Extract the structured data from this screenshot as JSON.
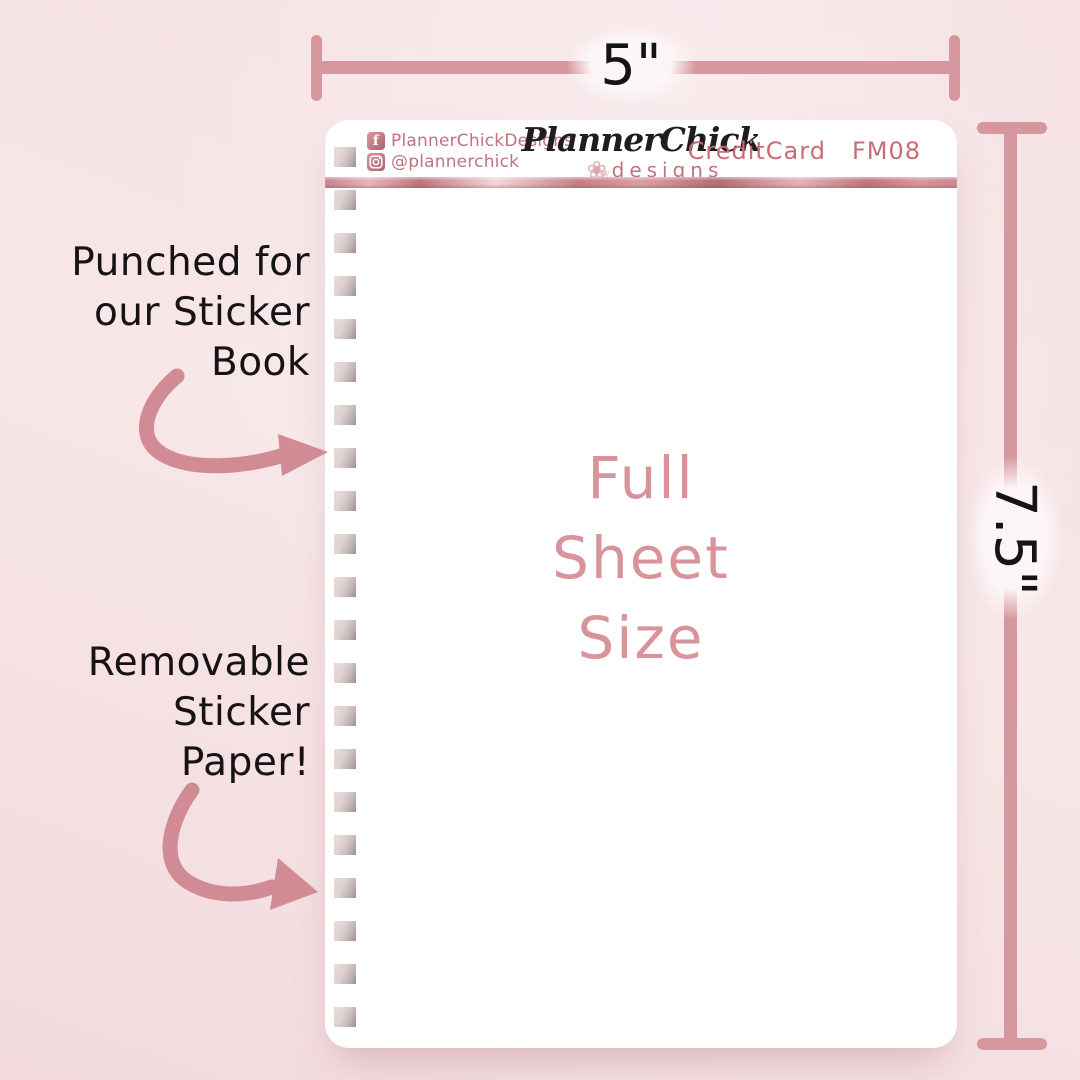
{
  "colors": {
    "background": "#f6e2e4",
    "sheet": "#ffffff",
    "dimension_line": "#d6979f",
    "arrow": "#d18b95",
    "social_text": "#c0737e",
    "product_text": "#c66d77",
    "logo_sub_text": "#c4737c",
    "center_text": "#d9949b",
    "annotation_text": "#161314",
    "rose_bar_light": "#f2d7d9",
    "rose_bar_dark": "#b46c76"
  },
  "sheet": {
    "punch_hole_count": 21,
    "header": {
      "facebook_label": "PlannerChickDesigns",
      "instagram_label": "@plannerchick",
      "logo_script": "PlannerChick",
      "logo_sub": "designs",
      "flower_glyph": "❀",
      "product_name": "CreditCard",
      "product_code": "FM08"
    },
    "center_text": {
      "line1": "Full",
      "line2": "Sheet",
      "line3": "Size"
    }
  },
  "dimensions": {
    "width_label": "5\"",
    "height_label": "7.5\""
  },
  "annotations": {
    "punched": {
      "line1": "Punched for",
      "line2": "our Sticker",
      "line3": "Book"
    },
    "removable": {
      "line1": "Removable",
      "line2": "Sticker",
      "line3": "Paper!"
    }
  }
}
